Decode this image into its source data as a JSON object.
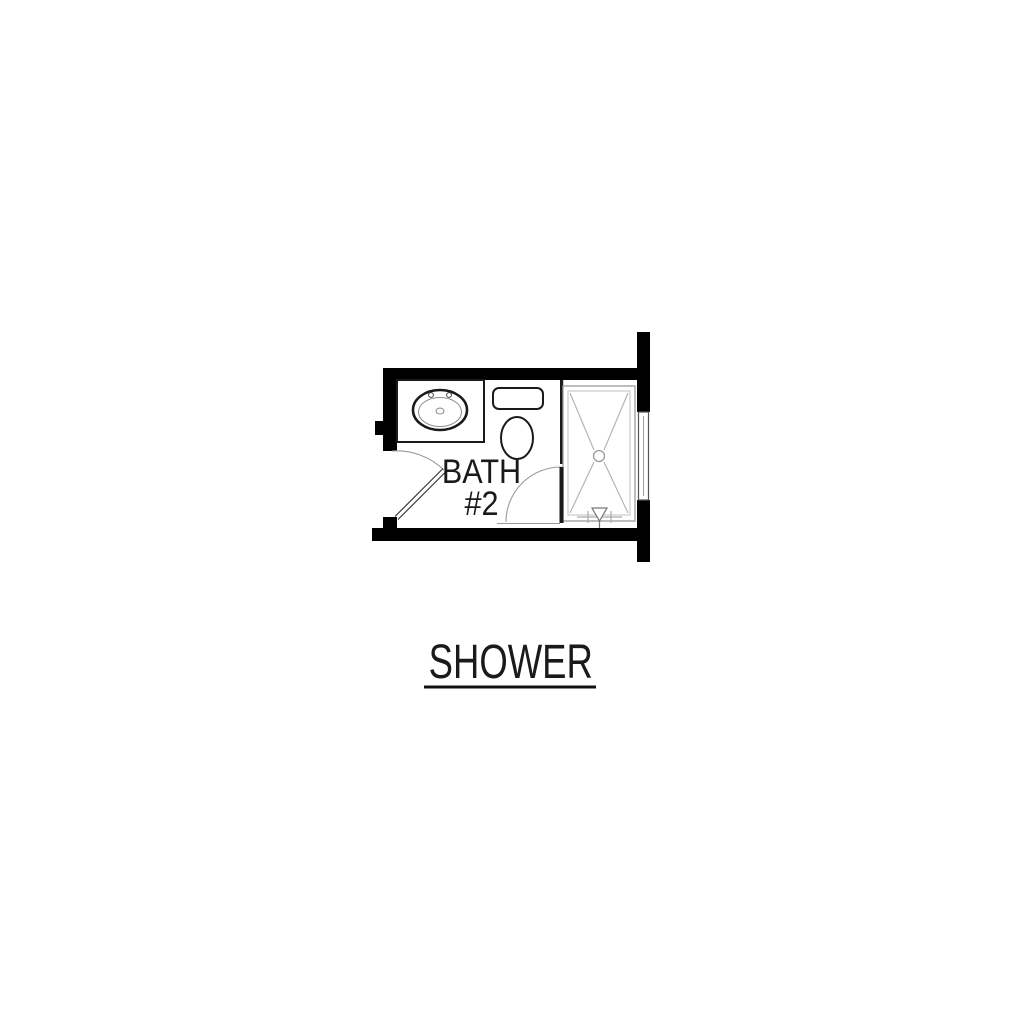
{
  "page": {
    "background": "#ffffff"
  },
  "plan": {
    "room_label_line1": "BATH",
    "room_label_line2": "#2",
    "caption": "SHOWER",
    "colors": {
      "wall": "#000000",
      "fixture": "#1a1a1a",
      "light_line": "#b5b5b5",
      "arc": "#9a9a9a",
      "text": "#1a1a1a"
    },
    "fixtures": [
      "vanity-with-oval-sink",
      "toilet",
      "shower-pan-with-drain",
      "shower-valve",
      "window",
      "entry-door-swing",
      "shower-door-swing"
    ]
  }
}
